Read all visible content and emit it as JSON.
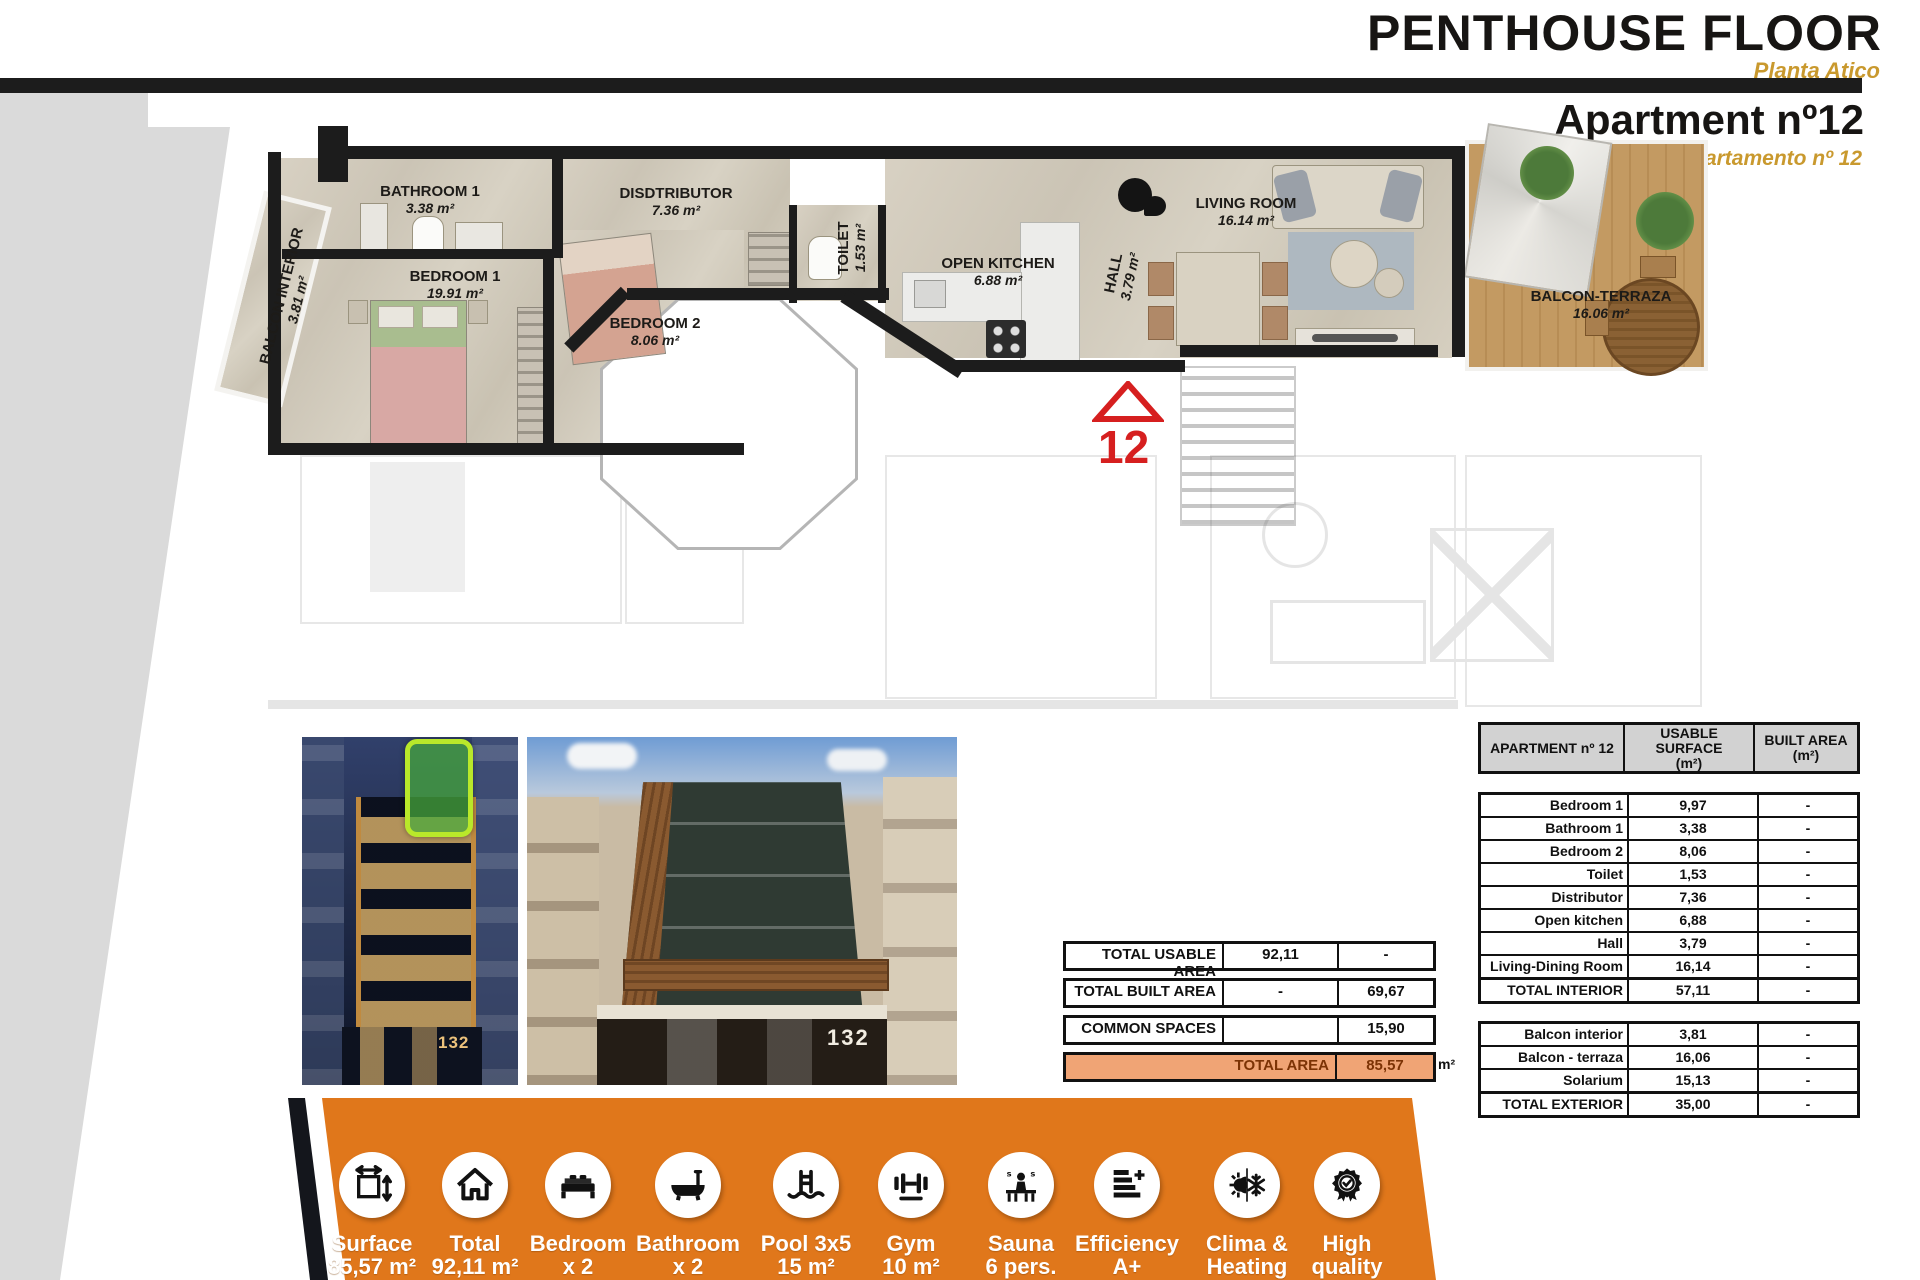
{
  "header": {
    "title": "PENTHOUSE FLOOR",
    "subtitle": "Planta Atico",
    "apartment_title": "Apartment nº12",
    "apartment_subtitle": "Apartamento nº 12"
  },
  "floor_plan": {
    "unit_marker": "12",
    "rooms": [
      {
        "name": "BALCON INTERIOR",
        "area": "3.81 m²"
      },
      {
        "name": "BATHROOM 1",
        "area": "3.38 m²"
      },
      {
        "name": "BEDROOM 1",
        "area": "19.91 m²"
      },
      {
        "name": "DISDTRIBUTOR",
        "area": "7.36 m²"
      },
      {
        "name": "BEDROOM 2",
        "area": "8.06 m²"
      },
      {
        "name": "TOILET",
        "area": "1.53 m²"
      },
      {
        "name": "OPEN KITCHEN",
        "area": "6.88 m²"
      },
      {
        "name": "HALL",
        "area": "3.79 m²"
      },
      {
        "name": "LIVING ROOM",
        "area": "16.14 m²"
      },
      {
        "name": "BALCON-TERRAZA",
        "area": "16.06 m²"
      }
    ]
  },
  "photos": {
    "p1_number": "132",
    "p2_number": "132"
  },
  "totals": [
    {
      "label": "TOTAL USABLE AREA",
      "usable": "92,11",
      "built": "-"
    },
    {
      "label": "TOTAL BUILT AREA",
      "usable": "-",
      "built": "69,67"
    },
    {
      "label": "COMMON SPACES",
      "usable": "",
      "built": "15,90"
    },
    {
      "label": "TOTAL AREA",
      "value": "85,57",
      "unit": "m²"
    }
  ],
  "area_table": {
    "header": {
      "col1": "APARTMENT nº 12",
      "col2a": "USABLE SURFACE",
      "col2b": "(m²)",
      "col3a": "BUILT AREA",
      "col3b": "(m²)"
    },
    "interior": [
      {
        "label": "Bedroom 1",
        "usable": "9,97",
        "built": "-"
      },
      {
        "label": "Bathroom 1",
        "usable": "3,38",
        "built": "-"
      },
      {
        "label": "Bedroom 2",
        "usable": "8,06",
        "built": "-"
      },
      {
        "label": "Toilet",
        "usable": "1,53",
        "built": "-"
      },
      {
        "label": "Distributor",
        "usable": "7,36",
        "built": "-"
      },
      {
        "label": "Open kitchen",
        "usable": "6,88",
        "built": "-"
      },
      {
        "label": "Hall",
        "usable": "3,79",
        "built": "-"
      },
      {
        "label": "Living-Dining Room",
        "usable": "16,14",
        "built": "-"
      },
      {
        "label": "TOTAL INTERIOR",
        "usable": "57,11",
        "built": "-"
      }
    ],
    "exterior": [
      {
        "label": "Balcon interior",
        "usable": "3,81",
        "built": "-"
      },
      {
        "label": "Balcon - terraza",
        "usable": "16,06",
        "built": "-"
      },
      {
        "label": "Solarium",
        "usable": "15,13",
        "built": "-"
      },
      {
        "label": "TOTAL EXTERIOR",
        "usable": "35,00",
        "built": "-"
      }
    ]
  },
  "features": {
    "items": [
      {
        "icon": "surface-icon",
        "l1": "Surface",
        "l2": "85,57 m²"
      },
      {
        "icon": "house-icon",
        "l1": "Total",
        "l2": "92,11 m²"
      },
      {
        "icon": "bed-icon",
        "l1": "Bedroom",
        "l2": "x 2"
      },
      {
        "icon": "bathtub-icon",
        "l1": "Bathroom",
        "l2": "x 2"
      },
      {
        "icon": "pool-icon",
        "l1": "Pool 3x5",
        "l2": "15 m²"
      },
      {
        "icon": "gym-icon",
        "l1": "Gym",
        "l2": "10 m²"
      },
      {
        "icon": "sauna-icon",
        "l1": "Sauna",
        "l2": "6 pers."
      },
      {
        "icon": "efficiency-icon",
        "l1": "Efficiency",
        "l2": "A+"
      },
      {
        "icon": "climate-icon",
        "l1": "Clima &",
        "l2": "Heating"
      },
      {
        "icon": "quality-icon",
        "l1": "High",
        "l2": "quality"
      }
    ]
  },
  "colors": {
    "orange": "#e0771b",
    "gold": "#c9992e",
    "red": "#d61f1f",
    "wall": "#1c1c1c",
    "gray_band": "#dadada",
    "table_header": "#d2d2d2",
    "total_fill": "#f0a475",
    "total_text": "#7c3305"
  }
}
